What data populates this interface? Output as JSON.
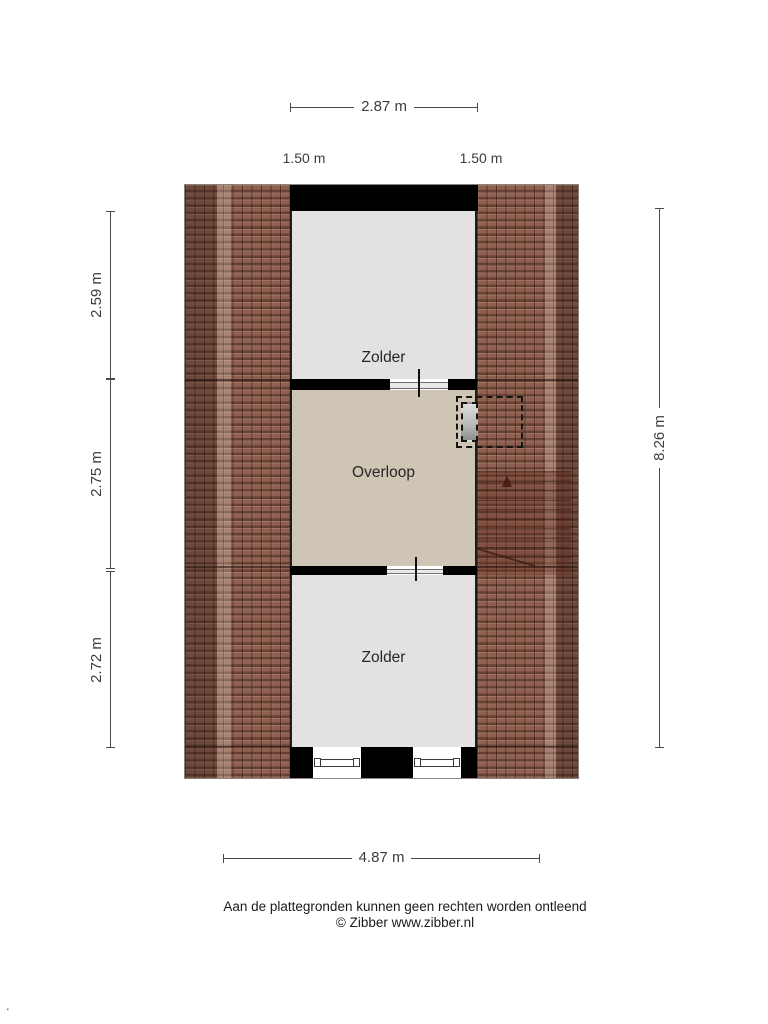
{
  "rooms": {
    "top": "Zolder",
    "middle": "Overloop",
    "bottom": "Zolder"
  },
  "dimensions": {
    "top_width": "2.87 m",
    "roof_left": "1.50 m",
    "roof_right": "1.50 m",
    "left_upper": "2.59 m",
    "left_middle": "2.75 m",
    "left_lower": "2.72 m",
    "right_total": "8.26 m",
    "bottom_width": "4.87 m"
  },
  "footer": {
    "disclaimer": "Aan de plattegronden kunnen geen rechten worden ontleend",
    "copyright": "© Zibber www.zibber.nl"
  },
  "misc": {
    "corner_dot": "."
  },
  "colors": {
    "roof_tile": "#8f604f",
    "floor_gray": "#e3e2e0",
    "floor_beige": "#cfc5b4",
    "wall": "#000000",
    "dimension": "#4a4a4a"
  }
}
